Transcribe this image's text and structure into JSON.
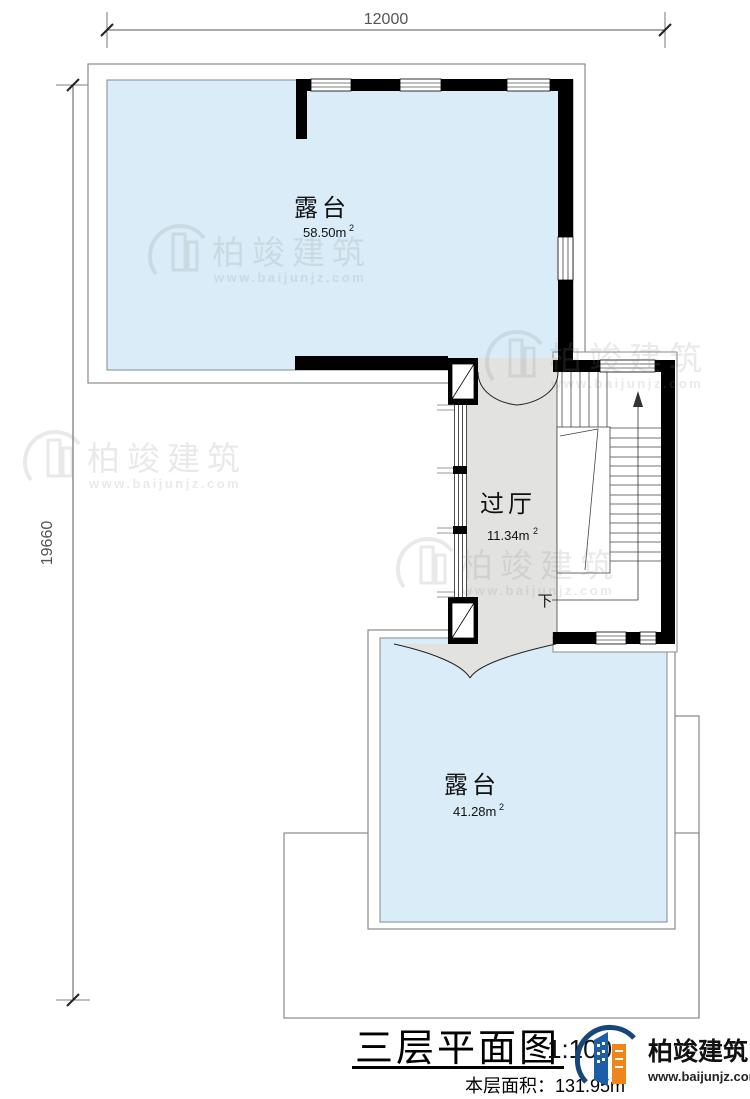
{
  "title_block": {
    "plan_title": "三层平面图",
    "scale": "1:100",
    "floor_area_text": "本层面积：131.95m",
    "floor_area_sup": "2"
  },
  "dimensions": {
    "top": "12000",
    "left": "19660"
  },
  "rooms": {
    "terrace_top": {
      "name": "露台",
      "area": "58.50m",
      "sup": "2"
    },
    "hall": {
      "name": "过厅",
      "area": "11.34m",
      "sup": "2"
    },
    "terrace_bottom": {
      "name": "露台",
      "area": "41.28m",
      "sup": "2"
    }
  },
  "stairs": {
    "down_label": "下"
  },
  "watermark": {
    "brand": "柏竣建筑",
    "url": "www.baijunjz.com"
  },
  "logo": {
    "brand": "柏竣建筑",
    "url": "www.baijunjz.com"
  },
  "colors": {
    "terrace_fill": "#d9ecf8",
    "hall_fill": "#e2e2e0",
    "wall": "#000000",
    "outline": "#8a8a8a",
    "logo_blue": "#1c5fa8",
    "logo_orange": "#f08519",
    "logo_swoosh": "#16477c"
  }
}
